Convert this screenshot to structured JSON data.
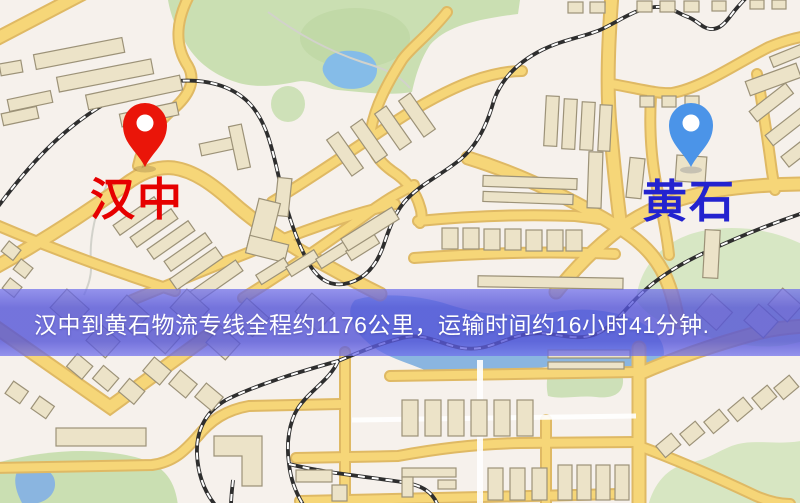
{
  "route_banner": {
    "text": "汉中到黄石物流专线全程约1176公里，运输时间约16小时41分钟."
  },
  "markers": {
    "origin": {
      "label": "汉中",
      "pin_color": "#ea1509",
      "label_color": "#e60000"
    },
    "destination": {
      "label": "黄石",
      "pin_color": "#4b94e8",
      "label_color": "#2323cf"
    }
  },
  "map_palette": {
    "background": "#f6f1ec",
    "road_fill": "#f6d678",
    "road_casing": "#dfb964",
    "minor_road": "#ffffff",
    "building_fill": "#ece3c8",
    "building_outline": "#9c9278",
    "park_green": "#cadfb2",
    "water_blue": "#8ab5e0",
    "railway_dark": "#2e2e2e",
    "banner_overlay": "rgba(84,84,216,0.80)",
    "banner_text_color": "#ffffff"
  }
}
